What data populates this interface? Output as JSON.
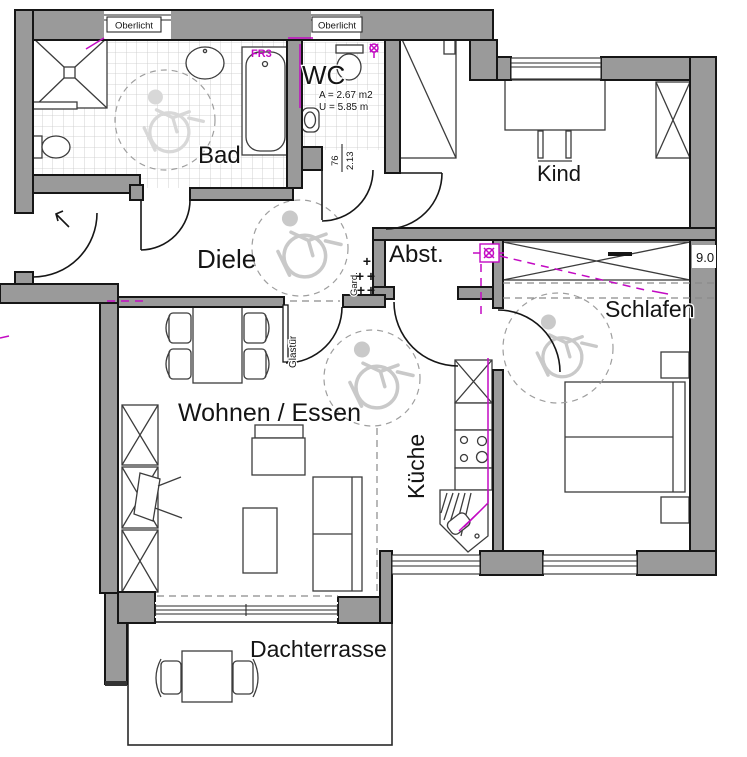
{
  "plan": {
    "rooms": {
      "bad": "Bad",
      "wc": "WC",
      "kind": "Kind",
      "diele": "Diele",
      "abst": "Abst.",
      "schlafen": "Schlafen",
      "wohnen": "Wohnen / Essen",
      "kueche": "Küche",
      "dachterrasse": "Dachterrasse"
    },
    "annotations": {
      "oberlicht": "Oberlicht",
      "glastuer": "Glastür",
      "garderobe": "Gard.",
      "garderobe_hook": "+",
      "fr3": "FR3",
      "wc_area": "A = 2.67 m2",
      "wc_perimeter": "U = 5.85 m",
      "door_width": "76",
      "door_height": "2.13",
      "dim_right": "9.0"
    },
    "colors": {
      "wall_fill": "#9a9a9a",
      "outline": "#161616",
      "tile_line": "#c7c7c7",
      "electric_magenta": "#c30ac3",
      "background": "#ffffff"
    }
  }
}
